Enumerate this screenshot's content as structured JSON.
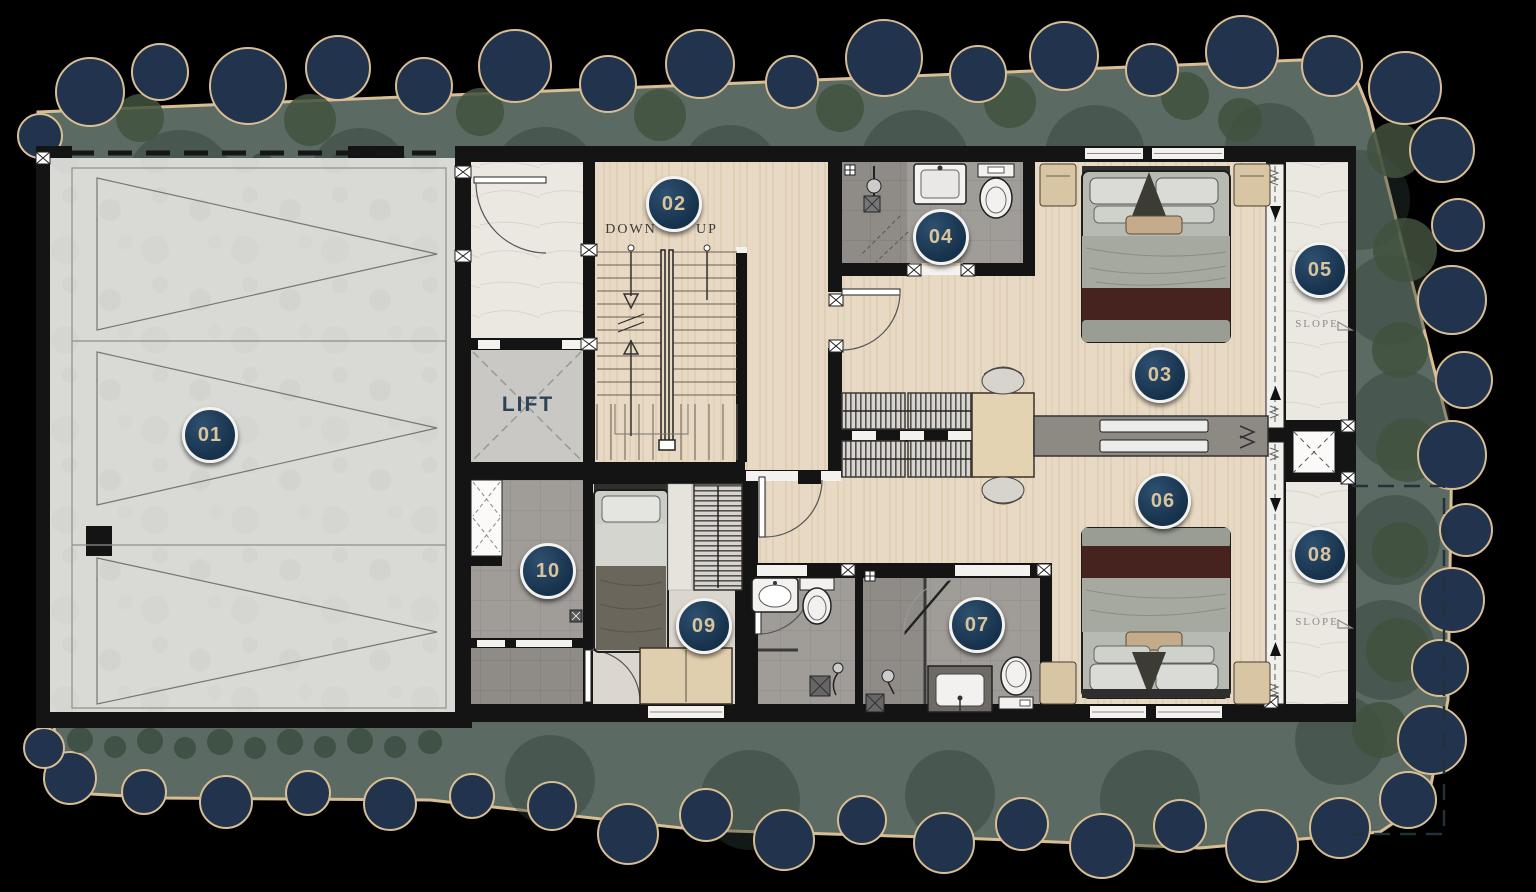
{
  "plan": {
    "badges": [
      {
        "number": "01"
      },
      {
        "number": "02"
      },
      {
        "number": "03"
      },
      {
        "number": "04"
      },
      {
        "number": "05"
      },
      {
        "number": "06"
      },
      {
        "number": "07"
      },
      {
        "number": "08"
      },
      {
        "number": "09"
      },
      {
        "number": "10"
      }
    ],
    "labels": {
      "lift": "LIFT",
      "down": "DOWN",
      "up": "UP",
      "slope_top": "SLOPE",
      "slope_bottom": "SLOPE"
    },
    "colors": {
      "badge_fill": "#1d3a57",
      "badge_ring": "#f4f2ee",
      "badge_text": "#d9c49b",
      "walls": "#151515",
      "wood_floor": "#e6d8c2",
      "concrete": "#d8d8d5",
      "marble": "#ebe8e2",
      "tile_gray": "#a09d99",
      "tile_dark": "#8f8c88",
      "terrace": "#ece8e1",
      "landscape": "#5b6a62",
      "tree_navy": "#22344d",
      "site_border_tan": "#d9be93",
      "lift_text": "#2c4257",
      "annotation_text": "#3a3a3a",
      "slope_text": "#8b8b85"
    }
  }
}
